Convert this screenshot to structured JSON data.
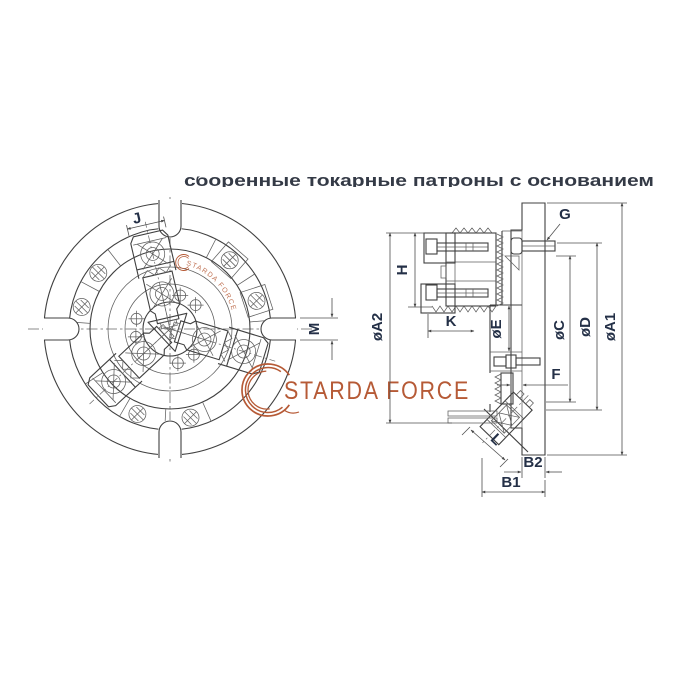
{
  "header": {
    "title": "сборённые токарные патроны с основанием"
  },
  "brand": {
    "logo_text": "STARDA FORCE",
    "watermark_text": "STARDA FORCE",
    "logo_color": "#b65a36"
  },
  "views": {
    "front": {
      "name": "front view of three-jaw lathe chuck with base",
      "labels": {
        "j": "J",
        "m": "M"
      }
    },
    "side": {
      "name": "side section view of chuck",
      "labels": {
        "g": "G",
        "h": "H",
        "oa2": "øA2",
        "k": "K",
        "oe": "øE",
        "oc": "øC",
        "od": "øD",
        "oa1": "øA1",
        "f": "F",
        "l": "L",
        "b2": "B2",
        "b1": "B1"
      }
    }
  },
  "colors": {
    "background": "#ffffff",
    "line": "#404040",
    "dimension_label": "#243047",
    "accent": "#b65a36"
  }
}
